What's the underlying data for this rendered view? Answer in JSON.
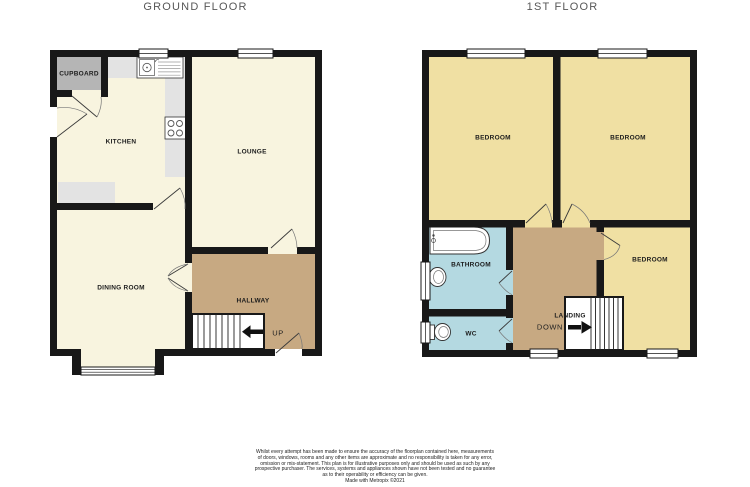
{
  "titles": {
    "ground": "GROUND FLOOR",
    "first": "1ST FLOOR"
  },
  "ground": {
    "labels": {
      "cupboard": "CUPBOARD",
      "kitchen": "KITCHEN",
      "lounge": "LOUNGE",
      "dining": "DINING ROOM",
      "hallway": "HALLWAY",
      "stairs": "UP"
    }
  },
  "first": {
    "labels": {
      "bedroom1": "BEDROOM",
      "bedroom2": "BEDROOM",
      "bedroom3": "BEDROOM",
      "bathroom": "BATHROOM",
      "wc": "WC",
      "landing": "LANDING",
      "stairs": "DOWN"
    }
  },
  "colors": {
    "wall": "#181818",
    "floor_cream": "#f8f4df",
    "floor_yellow": "#f0e0a3",
    "floor_tan": "#c7a982",
    "floor_blue": "#b4d9e1",
    "cupboard_gray": "#b5b5b5",
    "counter_gray": "#e3e3e3"
  },
  "disclaimer": {
    "lines": [
      "Whilst every attempt has been made to ensure the accuracy of the floorplan contained here, measurements",
      "of doors, windows, rooms and any other items are approximate and no responsibility is taken for any error,",
      "omission or mis-statement. This plan is for illustrative purposes only and should be used as such by any",
      "prospective purchaser. The services, systems and appliances shown have not been tested and no guarantee",
      "as to their operability or efficiency can be given."
    ],
    "credit": "Made with Metropix ©2021"
  }
}
